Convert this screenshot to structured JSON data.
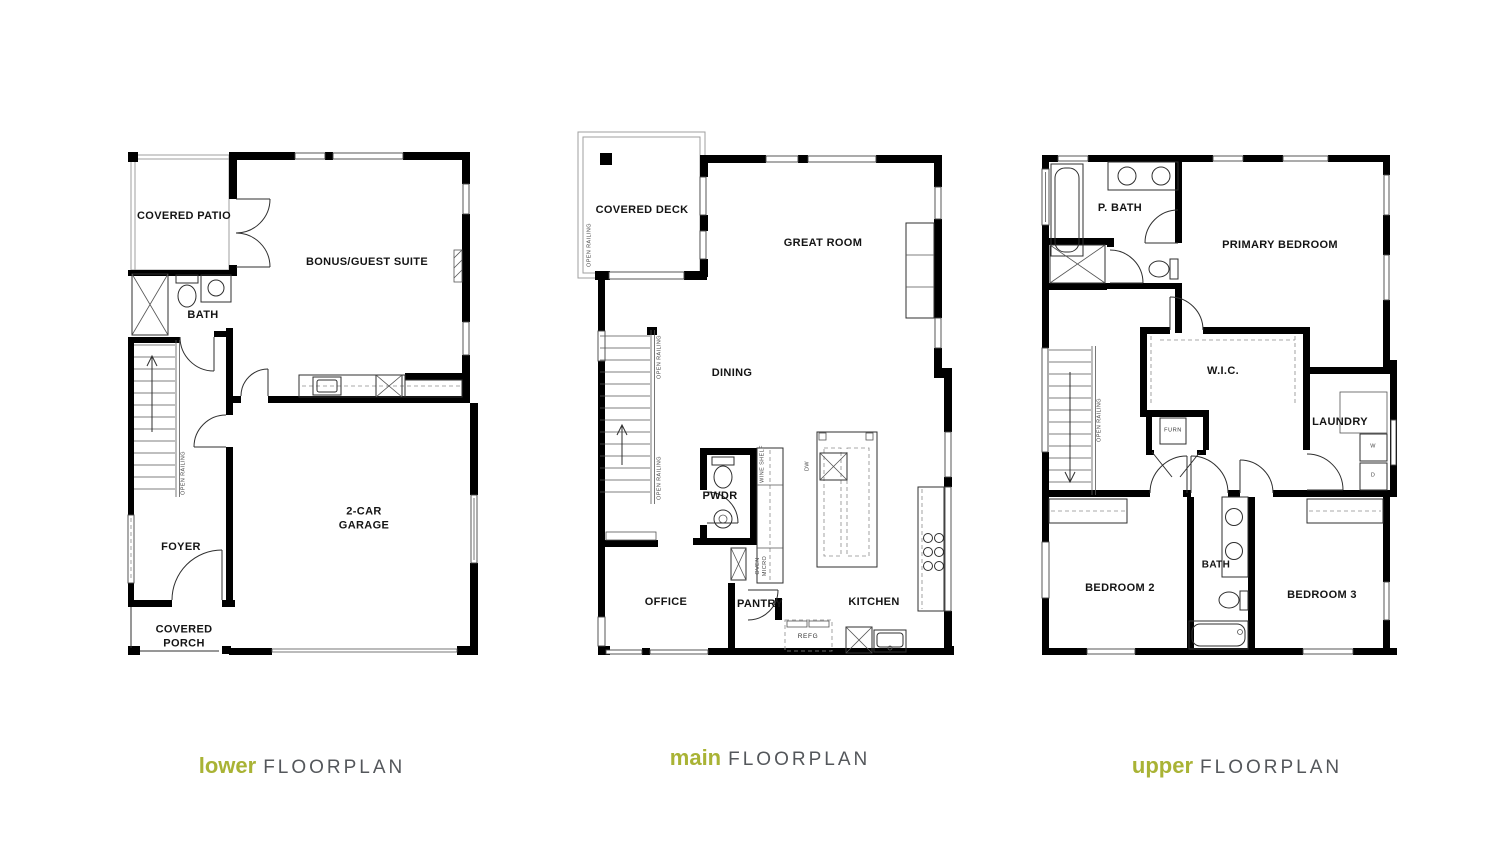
{
  "colors": {
    "accent": "#a9b335",
    "title_gray": "#54575b"
  },
  "titles": {
    "lower_accent": "lower",
    "lower_rest": "FLOORPLAN",
    "main_accent": "main",
    "main_rest": "FLOORPLAN",
    "upper_accent": "upper",
    "upper_rest": "FLOORPLAN"
  },
  "lower": {
    "covered_patio": "COVERED PATIO",
    "bonus_guest_suite": "BONUS/GUEST SUITE",
    "bath": "BATH",
    "foyer": "FOYER",
    "garage_line1": "2-CAR",
    "garage_line2": "GARAGE",
    "porch_line1": "COVERED",
    "porch_line2": "PORCH",
    "open_railing": "OPEN RAILING"
  },
  "main": {
    "covered_deck": "COVERED DECK",
    "great_room": "GREAT ROOM",
    "dining": "DINING",
    "pwdr": "PWDR",
    "office": "OFFICE",
    "pantry": "PANTRY",
    "kitchen": "KITCHEN",
    "refg": "REFG",
    "wine_shelf": "WINE SHELF",
    "oven_line1": "OVEN",
    "oven_line2": "MICRO",
    "island_label": "DW",
    "open_railing_deck": "OPEN RAILING",
    "open_railing_stairs_upper": "OPEN RAILING",
    "open_railing_stairs_lower": "OPEN RAILING"
  },
  "upper": {
    "p_bath": "P. BATH",
    "primary_bedroom": "PRIMARY BEDROOM",
    "wic": "W.I.C.",
    "laundry": "LAUNDRY",
    "furn": "FURN",
    "washer": "W",
    "dryer": "D",
    "bedroom2": "BEDROOM 2",
    "bath": "BATH",
    "bedroom3": "BEDROOM 3",
    "open_railing": "OPEN RAILING"
  }
}
